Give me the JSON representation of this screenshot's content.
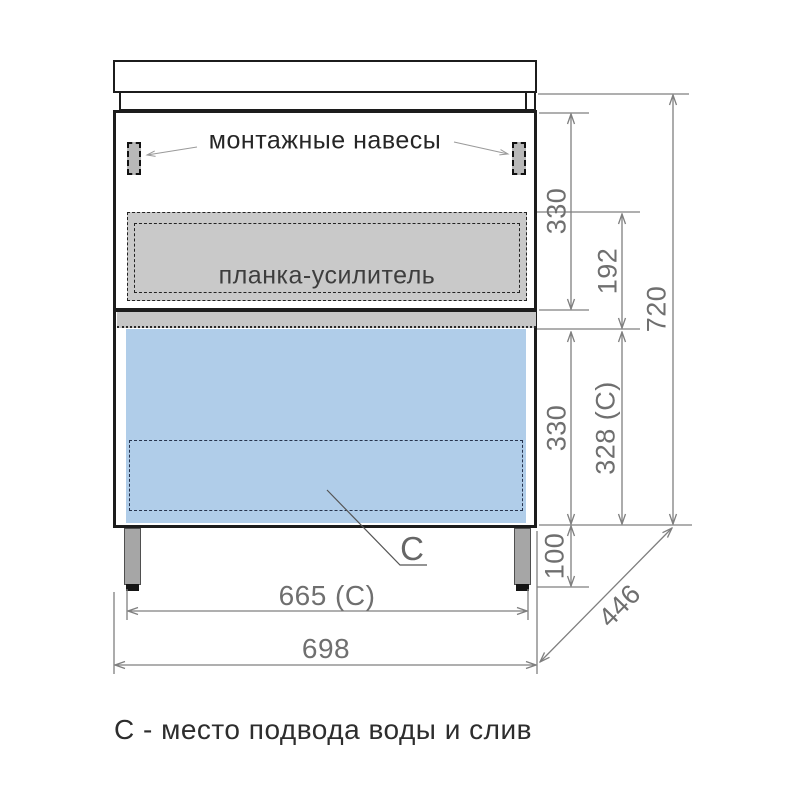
{
  "drawing": {
    "labels": {
      "mounting_hangers": "монтажные навесы",
      "reinforcement_bar": "планка-усилитель",
      "connection_marker": "С",
      "caption": "С - место подвода воды и слив"
    },
    "dimensions": {
      "upper_section_height": "330",
      "reinforcement_zone_height": "192",
      "total_height": "720",
      "lower_section_height": "330",
      "drawer_front_height": "328 (С)",
      "leg_height": "100",
      "legs_span_width": "665 (С)",
      "total_width": "698",
      "depth": "446"
    },
    "colors": {
      "line": "#1c1c1c",
      "dim": "#7f7f7f",
      "dimtext": "#6f6f6f",
      "bar_fill": "#c9c9c9",
      "band_fill": "#c6c6c6",
      "drawer_fill": "#b0cde9",
      "leg_fill": "#a6a6a6"
    }
  }
}
